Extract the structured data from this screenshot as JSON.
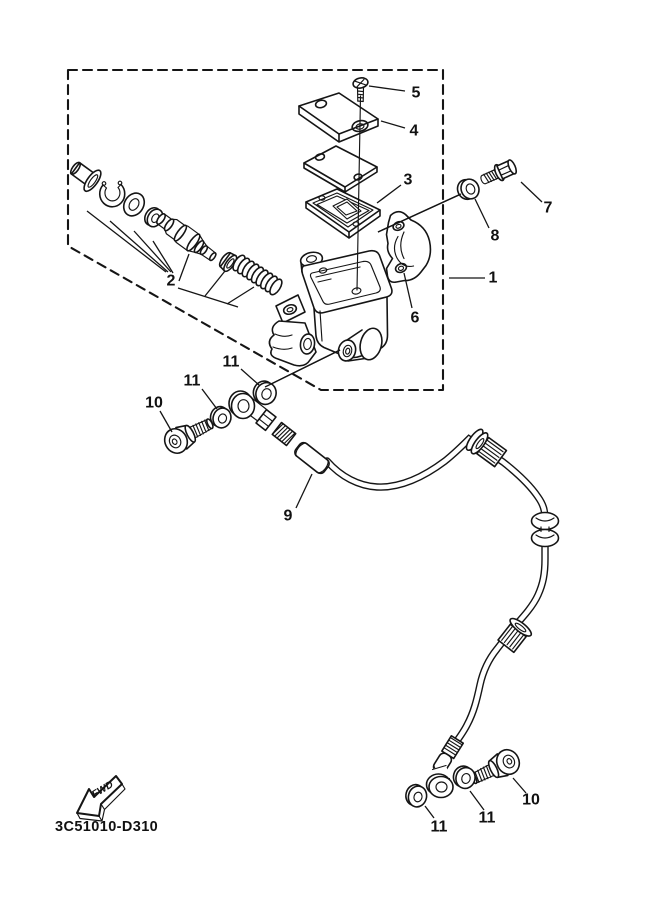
{
  "diagram": {
    "code": "3C51010-D310",
    "fwd_label": "FWD",
    "background_color": "#ffffff",
    "line_color": "#151515",
    "callouts": [
      {
        "part": "5",
        "x": 416,
        "y": 93,
        "leader": [
          369,
          86,
          405,
          91
        ]
      },
      {
        "part": "4",
        "x": 414,
        "y": 131,
        "leader": [
          381,
          121,
          405,
          128
        ]
      },
      {
        "part": "3",
        "x": 408,
        "y": 180,
        "leader": [
          377,
          203,
          401,
          185
        ]
      },
      {
        "part": "7",
        "x": 548,
        "y": 208,
        "leader": [
          521,
          182,
          542,
          202
        ]
      },
      {
        "part": "8",
        "x": 495,
        "y": 236,
        "leader": [
          475,
          199,
          489,
          228
        ]
      },
      {
        "part": "1",
        "x": 493,
        "y": 278,
        "leader": [
          449,
          278,
          485,
          278
        ]
      },
      {
        "part": "6",
        "x": 415,
        "y": 318,
        "leader": [
          404,
          273,
          412,
          308
        ]
      },
      {
        "part": "2",
        "x": 171,
        "y": 281,
        "leader": null
      },
      {
        "part": "11",
        "x": 231,
        "y": 362,
        "leader": [
          241,
          369,
          259,
          385
        ]
      },
      {
        "part": "11",
        "x": 192,
        "y": 381,
        "leader": [
          202,
          389,
          217,
          409
        ]
      },
      {
        "part": "10",
        "x": 154,
        "y": 403,
        "leader": [
          160,
          411,
          172,
          432
        ]
      },
      {
        "part": "9",
        "x": 288,
        "y": 516,
        "leader": [
          296,
          508,
          312,
          474
        ]
      },
      {
        "part": "11",
        "x": 439,
        "y": 827,
        "leader": [
          425,
          806,
          434,
          818
        ]
      },
      {
        "part": "11",
        "x": 487,
        "y": 818,
        "leader": [
          470,
          791,
          484,
          810
        ]
      },
      {
        "part": "10",
        "x": 531,
        "y": 800,
        "leader": [
          513,
          778,
          526,
          793
        ]
      }
    ],
    "assembly_lines": [
      [
        378,
        232,
        461,
        194
      ],
      [
        340,
        350,
        265,
        387
      ],
      [
        87,
        211,
        166,
        272
      ],
      [
        110,
        221,
        168,
        272
      ],
      [
        134,
        231,
        171,
        272
      ],
      [
        153,
        241,
        173,
        273
      ],
      [
        189,
        254,
        179,
        281
      ],
      [
        225,
        271,
        205,
        296
      ],
      [
        254,
        287,
        227,
        304
      ],
      [
        178,
        288,
        238,
        307
      ]
    ]
  }
}
